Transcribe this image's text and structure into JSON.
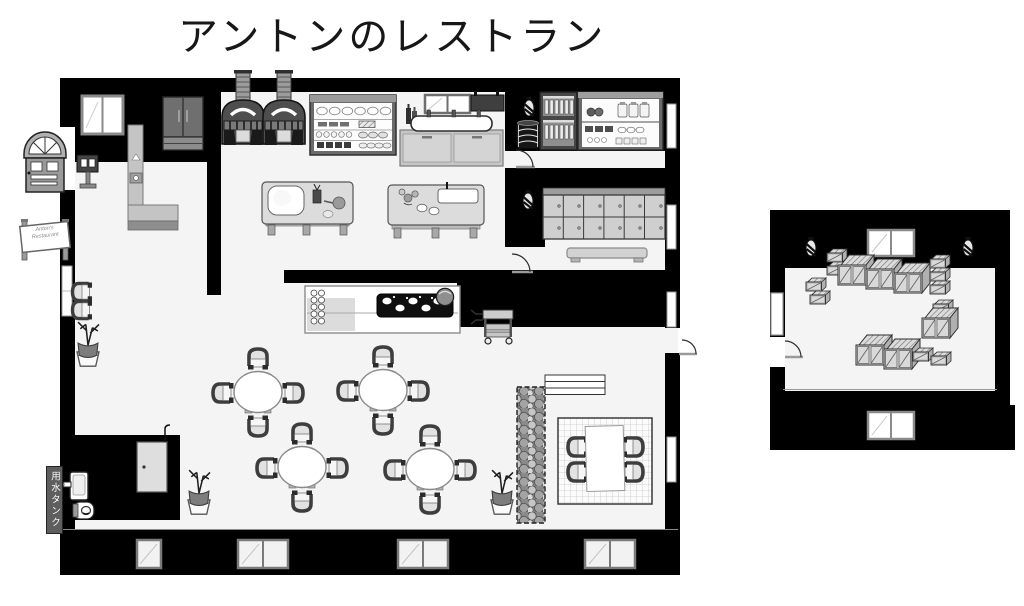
{
  "title": "アントンのレストラン",
  "signs": {
    "water_tank": "用水タンク",
    "entrance_sign_line1": "Anton's",
    "entrance_sign_line2": "Restaurant"
  },
  "palette": {
    "wall": "#000000",
    "floor": "#f4f4f4",
    "page_background": "#ffffff",
    "furniture_light": "#d9d9d9",
    "furniture_mid": "#999999",
    "furniture_dark": "#4a4a4a"
  },
  "buildings": {
    "restaurant": {
      "rooms": [
        "kitchen",
        "pantry",
        "staff-room",
        "dining-area",
        "restroom",
        "tatami-corner"
      ],
      "items": [
        "arched-entrance-door",
        "host-stand",
        "outdoor-sign",
        "wardrobe",
        "kitchen-counter",
        "pizza-oven",
        "pizza-oven",
        "dish-shelf",
        "sink-with-faucets",
        "pot-rack",
        "prep-table",
        "prep-table",
        "wine-rack",
        "food-shelf",
        "barrel",
        "wall-lantern",
        "wall-lantern",
        "locker-cabinet",
        "bench",
        "cooktop-counter",
        "serving-cart",
        "round-dining-table",
        "round-dining-table",
        "round-dining-table",
        "round-dining-table",
        "stacked-chairs",
        "potted-plant",
        "potted-plant",
        "potted-plant",
        "hedge-planter",
        "plank-shelf",
        "tatami-rug",
        "low-table",
        "toilet",
        "hand-sink",
        "sliding-door",
        "water-tank-sign",
        "windows"
      ]
    },
    "storage": {
      "rooms": [
        "store-room"
      ],
      "items": [
        "wooden-crate-stacks",
        "wall-lantern",
        "wall-lantern",
        "double-window",
        "double-window",
        "side-window",
        "entry-door"
      ]
    }
  }
}
